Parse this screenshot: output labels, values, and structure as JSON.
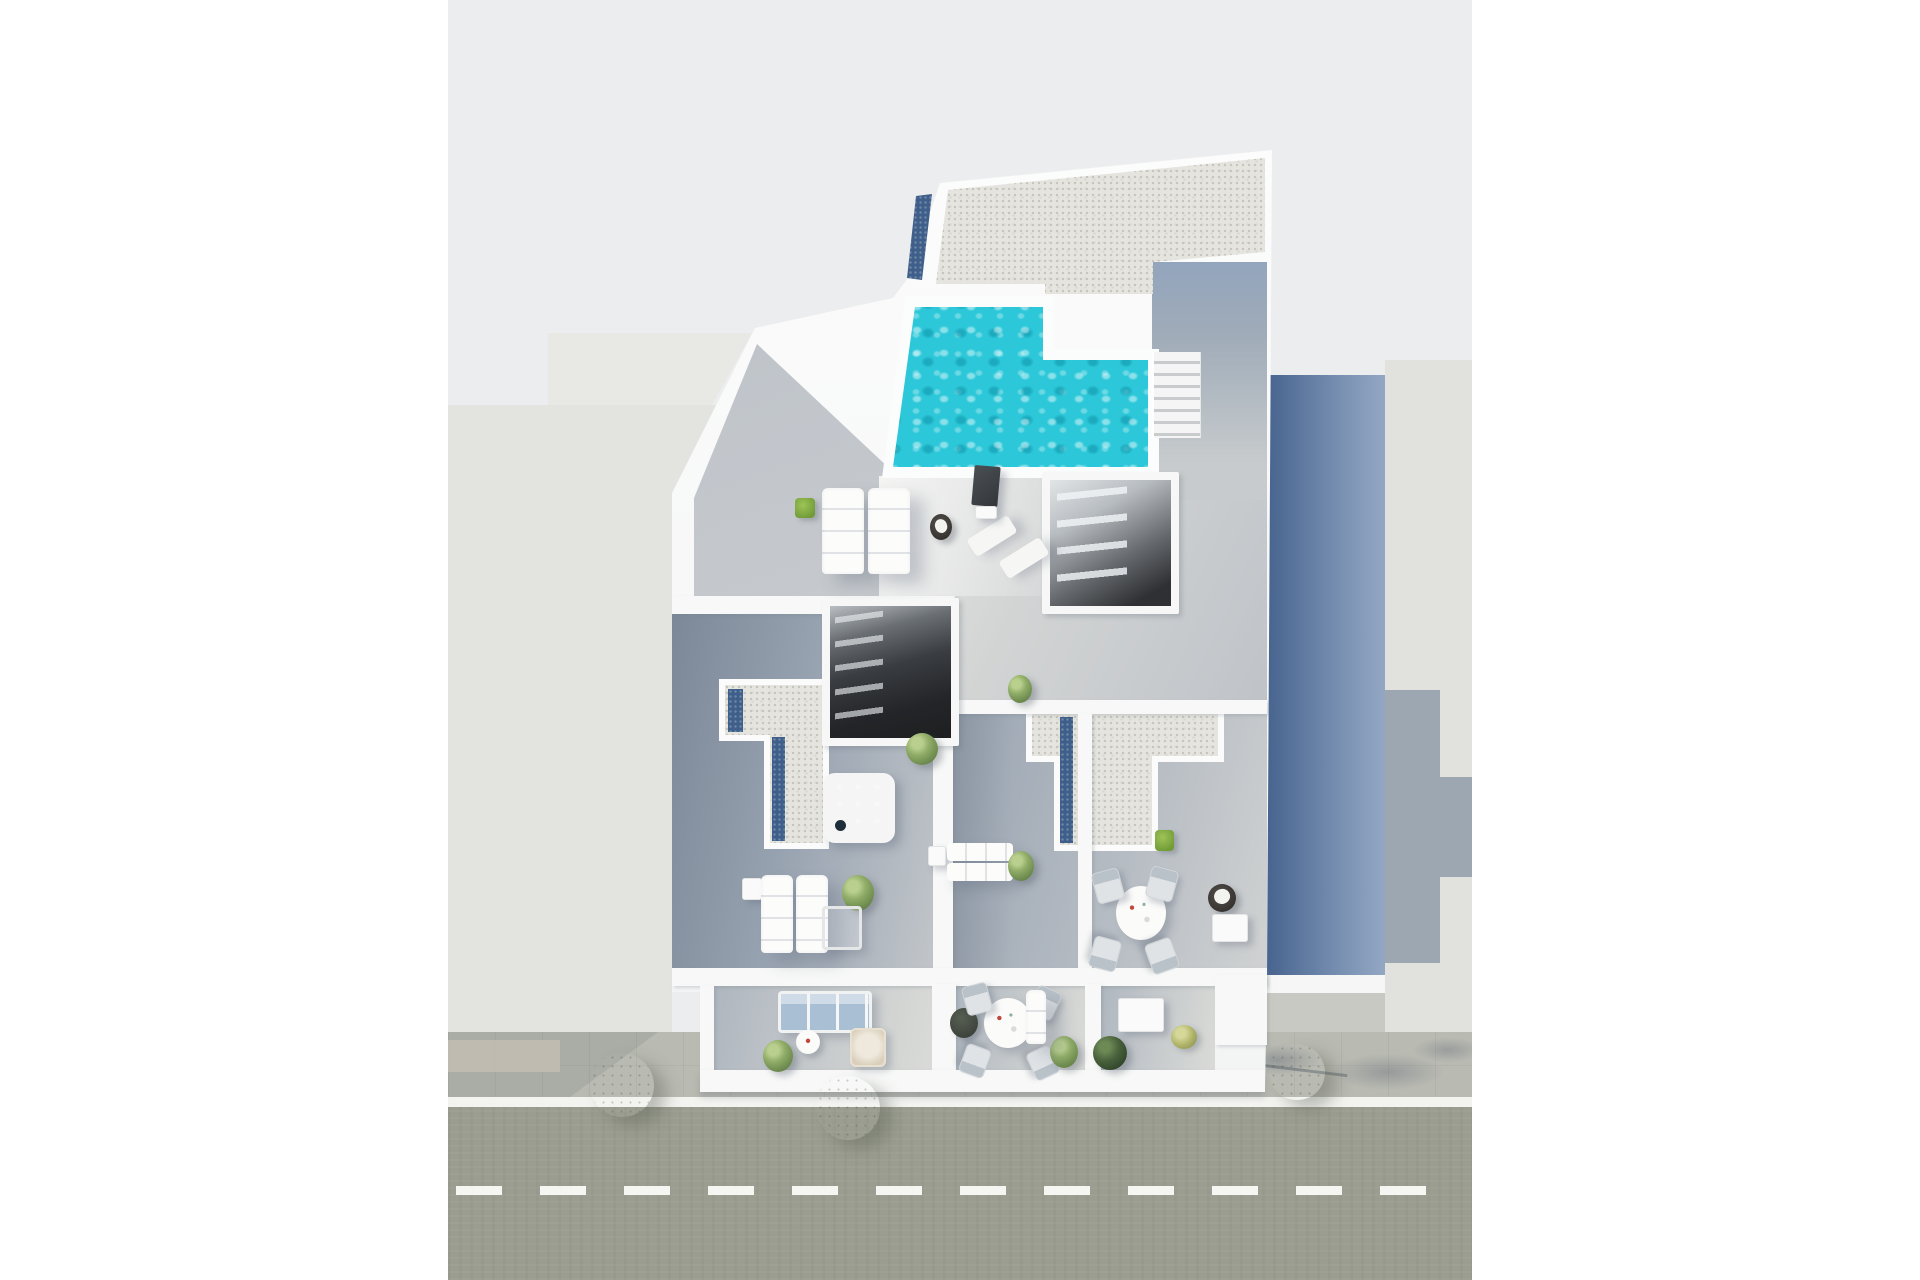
{
  "meta": {
    "type": "aerial-3d-architectural-render",
    "description": "Top-down 3D render of an apartment building rooftop and terraces with an L-shaped swimming pool, gravel roofs, jacuzzi, sun loungers, dining sets, lower balconies, sidewalk with trees and a street with a dashed lane line. Neighbouring flat-roofed buildings left and right; long blue shadow cast to the right.",
    "canvas": {
      "width": 1920,
      "height": 1280
    },
    "render_area": {
      "left": 448,
      "top": 0,
      "width": 1024,
      "height": 1280
    }
  },
  "palette": {
    "bg": "#ecedee",
    "nleft": "#e3e3df",
    "nright": "#e1e1dd",
    "sidewalk": "#b9bab2",
    "street": "#9b9d90",
    "solar": "#3f5f8a",
    "sofa": "#a9bfd4",
    "wall": "#f7f8f7",
    "pool_turquoise": "#2cc8d9",
    "pool_deep": "#0a487a",
    "facade_blue_dark": "#47648f",
    "facade_blue_light": "#93a7c3",
    "gravel": "#e5e4df",
    "jacuzzi_water": "#3e7fae",
    "tree_olive": "#b7b36e",
    "dash_line": "#fdfdfb"
  },
  "scene": {
    "regions": [
      "neighbour-building-left",
      "neighbour-building-right",
      "gravel-roof-top",
      "swimming-pool",
      "pool-deck",
      "roof-corridor",
      "roof-stairs",
      "skylight-stairwell-upper",
      "skylight-stairwell-mid",
      "left-terrace",
      "center-terrace",
      "right-terrace",
      "l-shaped-gravel-roof",
      "t-shaped-gravel-roof",
      "balcony-left",
      "balcony-center",
      "balcony-right",
      "blue-facade-wall",
      "cast-shadow",
      "sidewalk",
      "street"
    ],
    "items": [
      {
        "n": "sun-lounger",
        "cls": "lounger-v",
        "x": 374,
        "y": 488,
        "w": 42,
        "h": 86
      },
      {
        "n": "sun-lounger",
        "cls": "lounger-v",
        "x": 420,
        "y": 488,
        "w": 42,
        "h": 86
      },
      {
        "n": "planter-green",
        "cls": "pot-green",
        "x": 347,
        "y": 498,
        "w": 20,
        "h": 20
      },
      {
        "n": "side-table-towel",
        "cls": "stool-dark",
        "x": 482,
        "y": 514,
        "w": 22,
        "h": 26
      },
      {
        "n": "deck-chair",
        "cls": "lounger-flat",
        "x": 520,
        "y": 526,
        "w": 48,
        "h": 20,
        "rot": -32
      },
      {
        "n": "deck-chair",
        "cls": "lounger-flat",
        "x": 552,
        "y": 548,
        "w": 48,
        "h": 20,
        "rot": -32
      },
      {
        "n": "info-panel",
        "cls": "sign",
        "x": 525,
        "y": 466,
        "w": 26,
        "h": 40
      },
      {
        "n": "panel-base",
        "cls": "table-sq",
        "x": 527,
        "y": 506,
        "w": 22,
        "h": 13
      },
      {
        "n": "jacuzzi",
        "cls": "jacuzzi",
        "x": 375,
        "y": 773,
        "w": 72,
        "h": 70
      },
      {
        "n": "potted-plant",
        "cls": "bush",
        "x": 458,
        "y": 733,
        "w": 32,
        "h": 32
      },
      {
        "n": "potted-plant",
        "cls": "bush",
        "x": 560,
        "y": 675,
        "w": 24,
        "h": 28
      },
      {
        "n": "side-table",
        "cls": "table-sq",
        "x": 294,
        "y": 878,
        "w": 20,
        "h": 22
      },
      {
        "n": "sun-lounger",
        "cls": "lounger-v",
        "x": 313,
        "y": 875,
        "w": 32,
        "h": 78
      },
      {
        "n": "sun-lounger",
        "cls": "lounger-v",
        "x": 348,
        "y": 875,
        "w": 32,
        "h": 78
      },
      {
        "n": "potted-plant",
        "cls": "bush",
        "x": 394,
        "y": 875,
        "w": 32,
        "h": 36
      },
      {
        "n": "lounge-chair",
        "cls": "chair-ghost",
        "x": 374,
        "y": 906,
        "w": 34,
        "h": 38
      },
      {
        "n": "side-table",
        "cls": "table-sq",
        "x": 480,
        "y": 846,
        "w": 18,
        "h": 20
      },
      {
        "n": "sun-lounger",
        "cls": "lounger-h",
        "x": 499,
        "y": 843,
        "w": 66,
        "h": 18
      },
      {
        "n": "sun-lounger",
        "cls": "lounger-h",
        "x": 499,
        "y": 863,
        "w": 66,
        "h": 18
      },
      {
        "n": "potted-plant",
        "cls": "bush",
        "x": 560,
        "y": 851,
        "w": 26,
        "h": 30
      },
      {
        "n": "dining-table",
        "cls": "table-round",
        "x": 668,
        "y": 886,
        "w": 50,
        "h": 54
      },
      {
        "n": "dining-chair",
        "cls": "chair",
        "x": 646,
        "y": 870,
        "w": 26,
        "h": 30,
        "rot": -15
      },
      {
        "n": "dining-chair",
        "cls": "chair",
        "x": 700,
        "y": 868,
        "w": 26,
        "h": 30,
        "rot": 15
      },
      {
        "n": "dining-chair",
        "cls": "chair",
        "x": 643,
        "y": 938,
        "w": 26,
        "h": 30,
        "rot": 195
      },
      {
        "n": "dining-chair",
        "cls": "chair",
        "x": 700,
        "y": 940,
        "w": 26,
        "h": 30,
        "rot": 160
      },
      {
        "n": "fire-bowl",
        "cls": "stool-dark",
        "x": 760,
        "y": 884,
        "w": 28,
        "h": 28
      },
      {
        "n": "side-desk",
        "cls": "table-sq",
        "x": 764,
        "y": 914,
        "w": 36,
        "h": 28
      },
      {
        "n": "planter-cube",
        "cls": "pot-green",
        "x": 707,
        "y": 830,
        "w": 19,
        "h": 21
      },
      {
        "n": "sofa-blue",
        "cls": "sofa",
        "x": 330,
        "y": 991,
        "w": 88,
        "h": 36
      },
      {
        "n": "tray-table",
        "cls": "table-round-sm",
        "x": 348,
        "y": 1030,
        "w": 24,
        "h": 24
      },
      {
        "n": "wicker-chair",
        "cls": "wicker",
        "x": 402,
        "y": 1028,
        "w": 32,
        "h": 35
      },
      {
        "n": "potted-plant",
        "cls": "bush",
        "x": 315,
        "y": 1040,
        "w": 30,
        "h": 32
      },
      {
        "n": "planter-dark",
        "cls": "pot-dark",
        "x": 502,
        "y": 1008,
        "w": 28,
        "h": 30
      },
      {
        "n": "dining-table",
        "cls": "table-round",
        "x": 536,
        "y": 998,
        "w": 48,
        "h": 50
      },
      {
        "n": "dining-chair",
        "cls": "chair",
        "x": 516,
        "y": 984,
        "w": 24,
        "h": 28,
        "rot": -15
      },
      {
        "n": "dining-chair",
        "cls": "chair",
        "x": 584,
        "y": 988,
        "w": 24,
        "h": 28,
        "rot": 25
      },
      {
        "n": "dining-chair",
        "cls": "chair",
        "x": 514,
        "y": 1046,
        "w": 24,
        "h": 28,
        "rot": 200
      },
      {
        "n": "dining-chair",
        "cls": "chair",
        "x": 582,
        "y": 1048,
        "w": 24,
        "h": 28,
        "rot": 155
      },
      {
        "n": "potted-plant",
        "cls": "bush",
        "x": 602,
        "y": 1036,
        "w": 28,
        "h": 32
      },
      {
        "n": "recliner",
        "cls": "lounger-v",
        "x": 578,
        "y": 990,
        "w": 20,
        "h": 54
      },
      {
        "n": "balcony-table",
        "cls": "table-sq",
        "x": 670,
        "y": 998,
        "w": 46,
        "h": 34
      },
      {
        "n": "potted-plant",
        "cls": "bush-dark",
        "x": 645,
        "y": 1036,
        "w": 34,
        "h": 34
      },
      {
        "n": "potted-plant",
        "cls": "bush-light",
        "x": 723,
        "y": 1025,
        "w": 26,
        "h": 24
      },
      {
        "n": "street-tree",
        "cls": "tree",
        "x": 142,
        "y": 1053,
        "w": 64,
        "h": 64
      },
      {
        "n": "street-tree",
        "cls": "tree",
        "x": 368,
        "y": 1076,
        "w": 64,
        "h": 64
      },
      {
        "n": "street-tree",
        "cls": "tree",
        "x": 821,
        "y": 1044,
        "w": 56,
        "h": 56
      }
    ]
  }
}
